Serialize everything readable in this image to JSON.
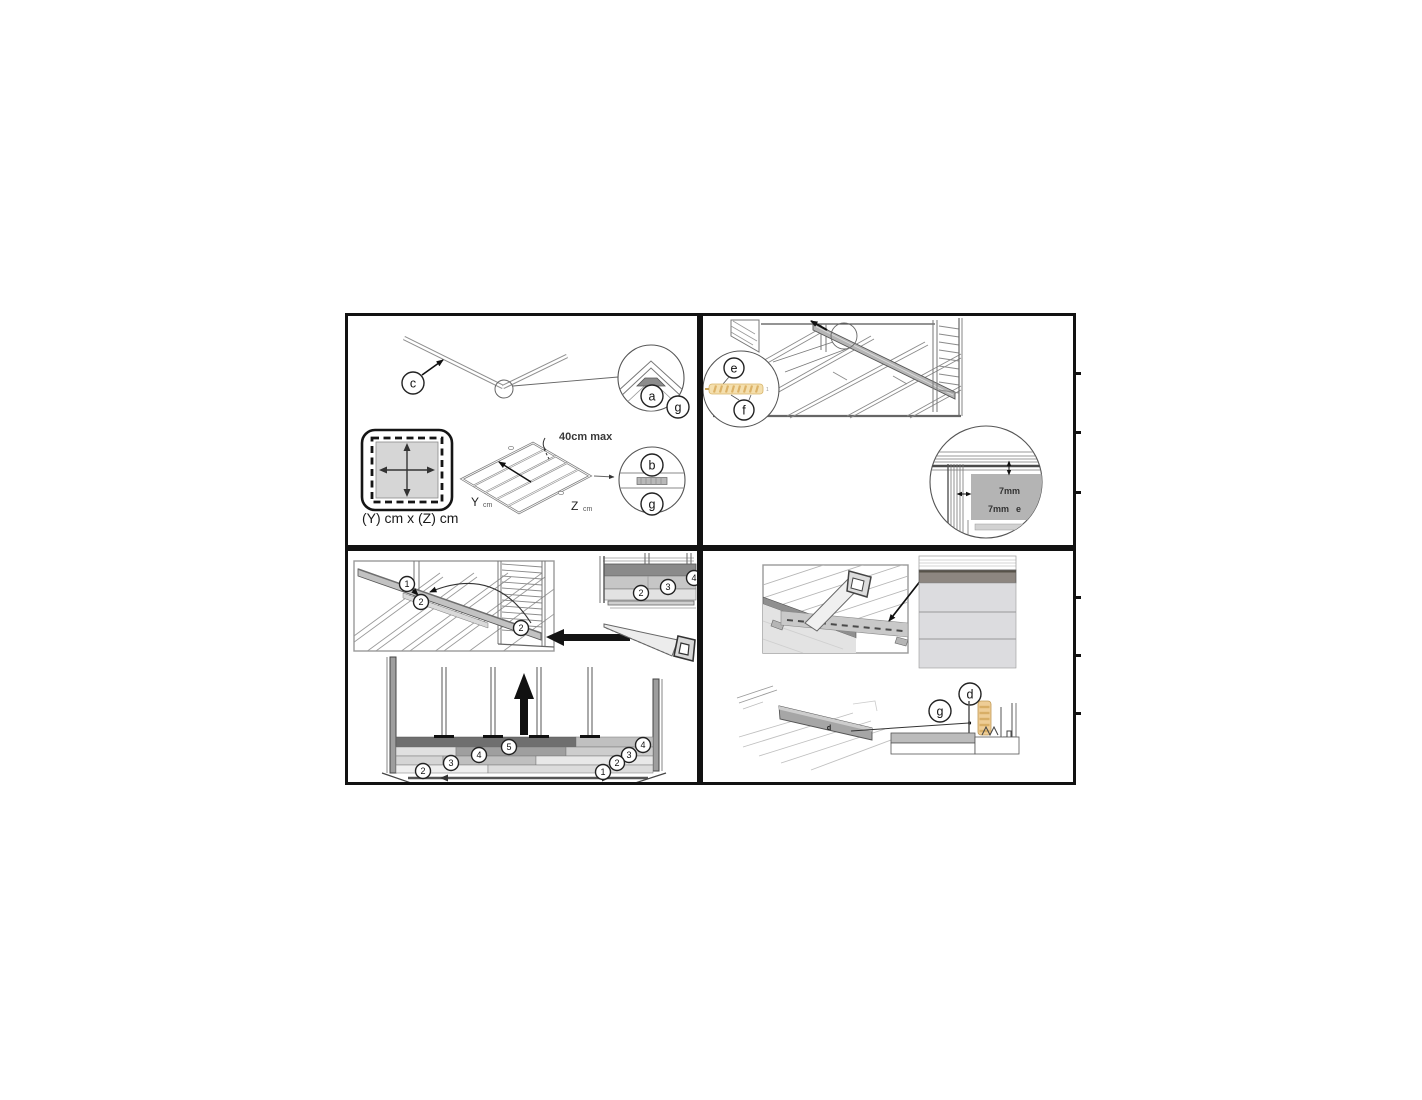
{
  "document": {
    "type": "assembly-instructions",
    "background": "#ffffff",
    "border_color": "#121212"
  },
  "colors": {
    "line_gray": "#777777",
    "light_plank": "#d9d9d9",
    "mid_plank": "#b5b5b5",
    "dark_plank": "#6f6f6f",
    "wall_band": "#8d8680",
    "wood_tan": "#f2dca6",
    "detail_gray": "#b4b4b4"
  },
  "panel1": {
    "name": "roof-ridge-and-floor-frame",
    "callout_c": "c",
    "callout_a": "a",
    "callout_g1": "g",
    "callout_b": "b",
    "callout_g2": "g",
    "max_spacing": "40cm max",
    "y_label": "Y",
    "y_unit": "cm",
    "z_label": "Z",
    "z_unit": "cm",
    "footprint_caption": "(Y) cm x (Z) cm"
  },
  "panel2": {
    "name": "floor-board-installation",
    "callout_e": "e",
    "callout_f": "f",
    "plank_mark": "1",
    "gap_top": "7mm",
    "gap_side": "7mm",
    "gap_part_label": "e"
  },
  "panel3": {
    "name": "wall-plank-assembly",
    "plank_step_1": "1",
    "plank_step_2a": "2",
    "plank_step_2b": "2",
    "stack_2": "2",
    "stack_3": "3",
    "stack_4": "4",
    "row_left_2": "2",
    "row_left_3": "3",
    "row_left_4": "4",
    "row_left_5": "5",
    "row_right_4": "4",
    "row_right_3": "3",
    "row_right_2": "2",
    "row_right_1": "1"
  },
  "panel4": {
    "name": "skirting-and-trim-finish",
    "board_label": "d",
    "callout_g": "g",
    "callout_d": "d"
  }
}
